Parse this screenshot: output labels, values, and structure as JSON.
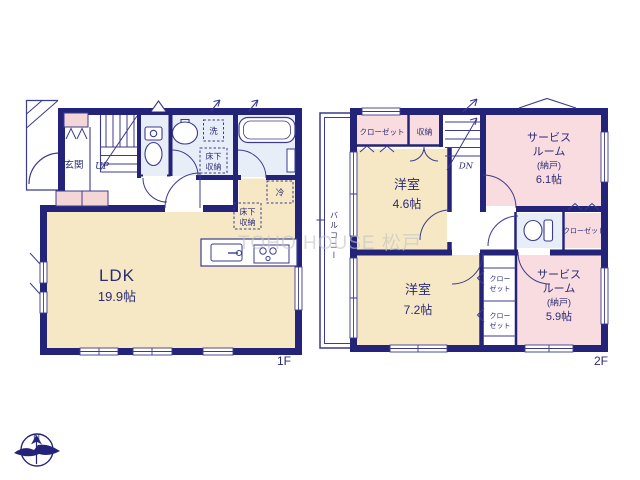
{
  "colors": {
    "wall": "#232379",
    "thin_line": "#3b3b8f",
    "text": "#2b2b74",
    "room_cream": "#f6e8c5",
    "room_pink": "#f8dcdf",
    "room_blue": "#e8eef8",
    "cabinet_pink": "#f4d6d6",
    "watermark": "#c3c3c3"
  },
  "watermark": "TOHO HOUSE 松戸",
  "compass": {
    "north": "N"
  },
  "floor1": {
    "label": "1F",
    "genkan": "玄関",
    "stairs": "UP",
    "wash_label": "洗",
    "underfloor1": {
      "line1": "床下",
      "line2": "収納"
    },
    "underfloor2": {
      "line1": "床下",
      "line2": "収納"
    },
    "fridge": "冷",
    "ldk": {
      "name": "LDK",
      "size": "19.9帖"
    }
  },
  "floor2": {
    "label": "2F",
    "balcony": "バルコニー",
    "closet_top": "クローゼット",
    "storage": "収納",
    "stairs": "DN",
    "service_room_a": {
      "name1": "サービス",
      "name2": "ルーム",
      "sub": "(納戸)",
      "size": "6.1帖"
    },
    "bedroom_a": {
      "name": "洋室",
      "size": "4.6帖"
    },
    "closet_right": "クローゼット",
    "bedroom_b": {
      "name": "洋室",
      "size": "7.2帖"
    },
    "closet_small_a": {
      "line1": "クロー",
      "line2": "ゼット"
    },
    "closet_small_b": {
      "line1": "クロー",
      "line2": "ゼット"
    },
    "service_room_b": {
      "name1": "サービス",
      "name2": "ルーム",
      "sub": "(納戸)",
      "size": "5.9帖"
    }
  }
}
